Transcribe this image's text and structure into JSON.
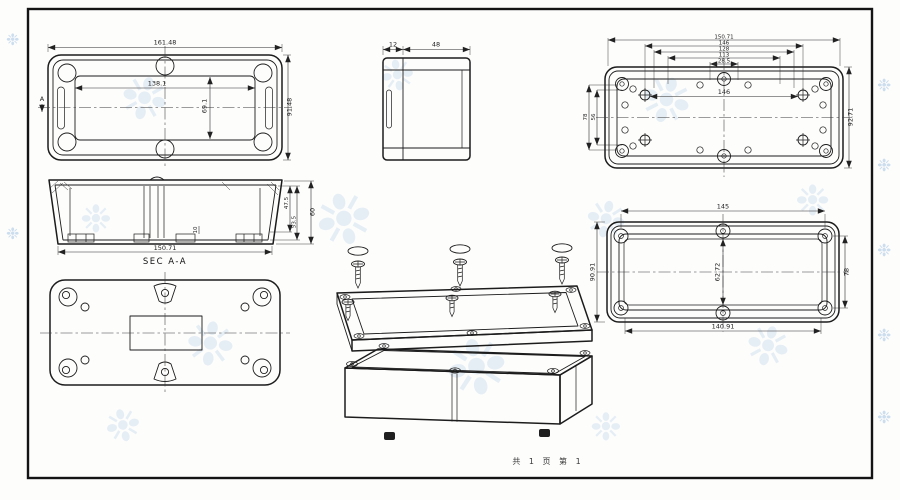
{
  "sheet": {
    "footer": "共 1 页  第 1"
  },
  "watermark": {
    "glyph": "❉"
  },
  "colors": {
    "line": "#1c1c1c",
    "watermark": "#a8c6e4",
    "paper": "#ffffff"
  },
  "views": {
    "cover_top": {
      "section_marker": "A",
      "dims": {
        "outer_width": "161.48",
        "inner_width": "138.1",
        "inner_height": "69.1",
        "outer_height": "91.48"
      }
    },
    "side": {
      "dims": {
        "lid": "12",
        "body": "48"
      }
    },
    "base_inside": {
      "dims": {
        "stack": [
          "150.71",
          "146",
          "128",
          "113",
          "28.5"
        ],
        "inner_width": "146",
        "right_height": "92.71",
        "left_outer": "78",
        "left_inner": "56"
      }
    },
    "section": {
      "label": "SEC A-A",
      "dims": {
        "width": "150.71",
        "outer_height": "60",
        "depth_a": "47.5",
        "depth_b": "53.5",
        "boss": "10"
      }
    },
    "lid_inside": {
      "dims": {
        "top": "145",
        "bottom": "140.91",
        "left": "90.91",
        "right": "78",
        "center": "62.72"
      }
    }
  }
}
